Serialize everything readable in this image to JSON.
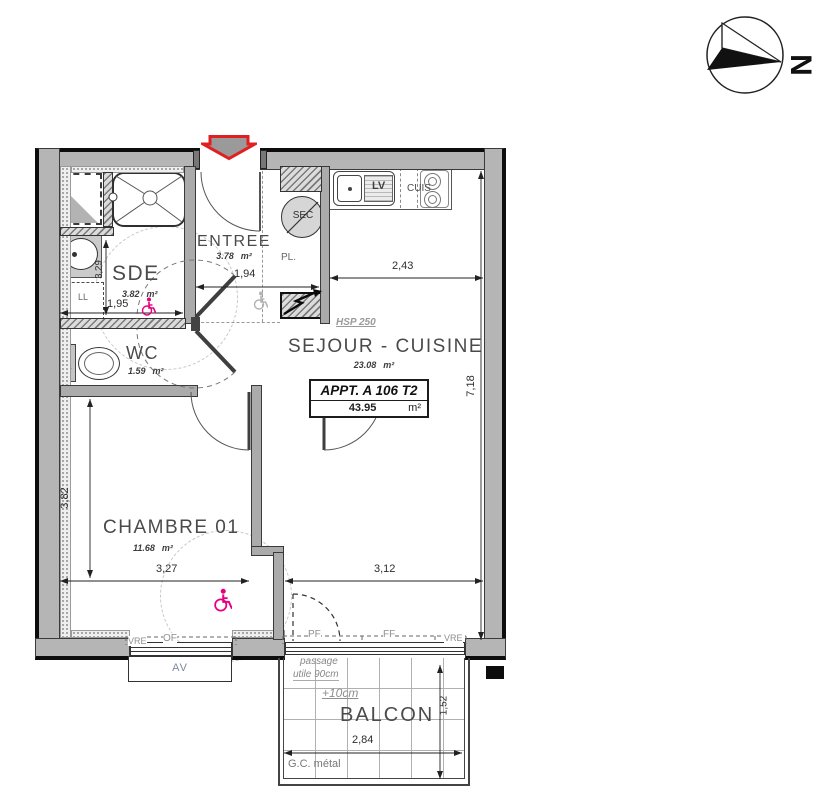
{
  "compass": {
    "north_label": "N"
  },
  "apartment_box": {
    "title": "APPT. A 106 T2",
    "area": "43.95",
    "unit": "m²"
  },
  "rooms": {
    "entree": {
      "name": "ENTREE",
      "area": "3.78",
      "unit": "m²"
    },
    "sde": {
      "name": "SDE",
      "area": "3.82",
      "unit": "m²"
    },
    "wc": {
      "name": "WC",
      "area": "1.59",
      "unit": "m²"
    },
    "sejour": {
      "name": "SEJOUR - CUISINE",
      "area": "23.08",
      "unit": "m²",
      "ceiling_note": "HSP 250"
    },
    "chambre": {
      "name": "CHAMBRE 01",
      "area": "11.68",
      "unit": "m²"
    },
    "balcon": {
      "name": "BALCON"
    }
  },
  "fixtures": {
    "dishwasher": "LV",
    "cooktop": "CUIS",
    "dryer": "SEC",
    "closet": "PL.",
    "washer": "LL",
    "toilet_mark": "+"
  },
  "dimensions": {
    "entree_width": "1,94",
    "kitchen_width": "2,43",
    "right_height": "7,18",
    "sde_height": "3,29",
    "sde_width": "1,95",
    "chambre_height": "3,82",
    "chambre_width": "3,27",
    "sejour_width": "3,12",
    "balcon_width": "2,84",
    "balcon_depth": "1,52"
  },
  "windows": {
    "chambre_shutter": "VRE",
    "chambre_type": "OF",
    "sill_box": "AV",
    "sejour_door": "PF",
    "sejour_fixed": "FF",
    "sejour_shutter": "VRE"
  },
  "balcony": {
    "passage_line1": "passage",
    "passage_line2": "utile 90cm",
    "level_offset": "+10cm",
    "railing": "G.C. métal"
  }
}
